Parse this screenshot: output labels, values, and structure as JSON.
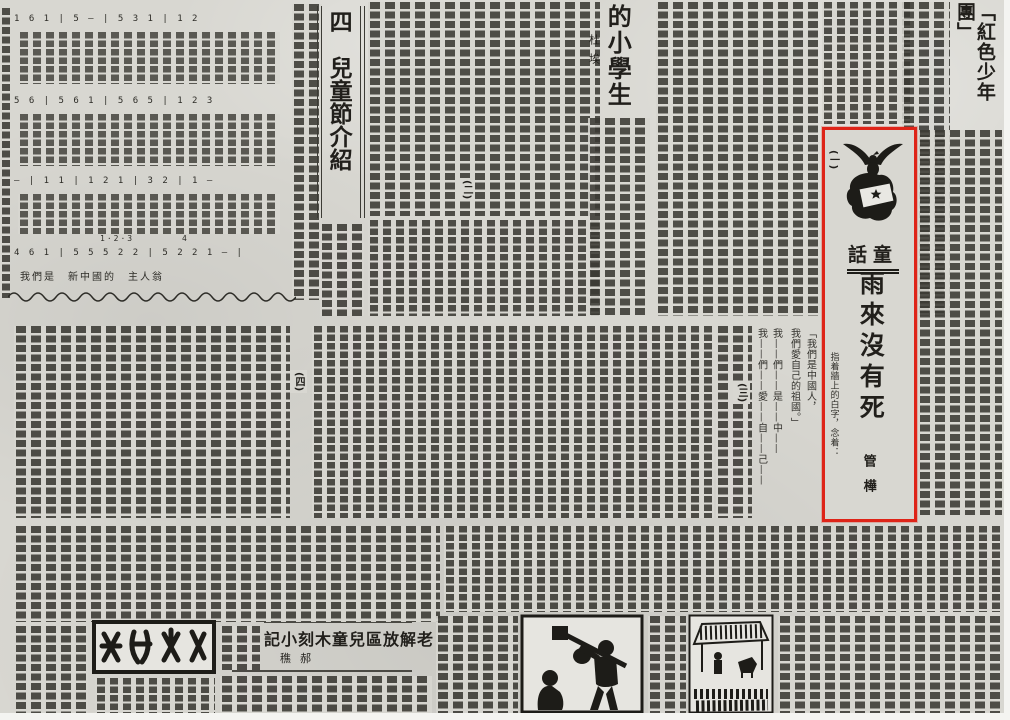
{
  "colors": {
    "paper": "#d8d7d1",
    "paper_margin": "#f4f4f1",
    "ink": "#3b3a34",
    "headline_ink": "#211f1b",
    "highlight_red": "#de2418"
  },
  "articles": {
    "hongse_shaoniantuan": {
      "headline": "「紅色少年團」"
    },
    "ertongjie_jieshao": {
      "headline": "四　兒童節介紹",
      "marker_2": "(二)"
    },
    "de_xiaoxuesheng": {
      "headline": "的小學生",
      "author": "杜埃"
    },
    "yulai": {
      "column_tag": "童話",
      "title": "雨來沒有死",
      "author": "管樺",
      "marker_1": "(一)",
      "marker_3": "(三)",
      "marker_4": "(四)",
      "lines": {
        "l0": "指着牆上的白字，念着：",
        "l1": "「我們是中國人，",
        "l2": "我們愛自己的祖國。」",
        "l3": "我——們——是——中——",
        "l4": "我——們——愛——自——己——"
      }
    },
    "muke_xiaoji": {
      "headline": "老解放區兒童木刻小記",
      "author": "郝穛"
    }
  },
  "music_score": {
    "systems": {
      "s1": "1 6 1 | 5 — | 5 3 1 | 1 2",
      "s2": "5 6 | 5 6 1 | 5 6 5 | 1 2 3",
      "s3": "— | 1 1 | 1 2 1 | 3 2 | 1 —",
      "s4": "4 6 1 | 5 5 5 2 2 | 5 2 2 1 — |"
    },
    "measure_labels": {
      "a": "1·2·3",
      "b": "4"
    },
    "last_lyric": "我們是　新中國的　主人翁"
  },
  "annotation": {
    "red_box_role": "highlight-box"
  }
}
